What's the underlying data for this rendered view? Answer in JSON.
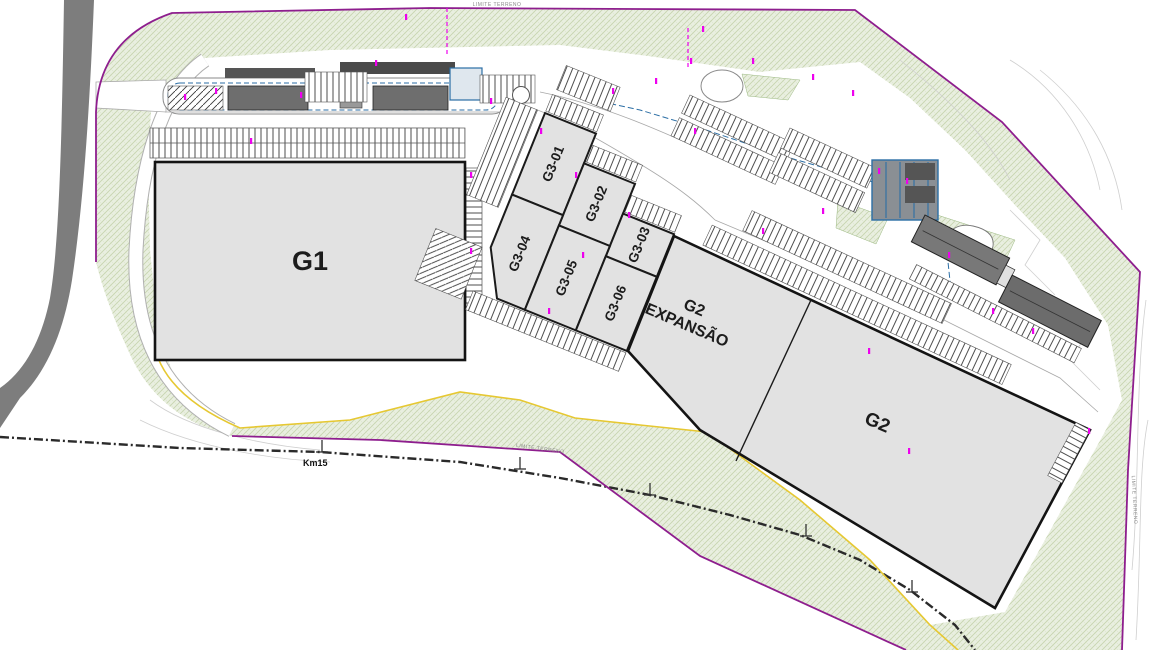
{
  "plan": {
    "title": "industrial-park-site-plan",
    "buildings": {
      "g1": "G1",
      "g2": "G2",
      "g2_expansion": {
        "line1": "G2",
        "line2": "EXPANSÃO"
      },
      "g3_units": [
        "G3-01",
        "G3-02",
        "G3-03",
        "G3-04",
        "G3-05",
        "G3-06"
      ]
    },
    "annotations": {
      "road_marker": "Km15",
      "boundary_label": "LIMITE TERRENO"
    },
    "colors": {
      "boundary_purple": "#8e1e8e",
      "vegetation_green": "#e9efe0",
      "building_fill": "#e2e2e2",
      "building_outline": "#1a1a1a",
      "road_gray": "#7d7d7d",
      "marker_magenta": "#ee00ee",
      "utility_blue": "#2b6ea5",
      "curb_yellow": "#e6c832"
    }
  }
}
